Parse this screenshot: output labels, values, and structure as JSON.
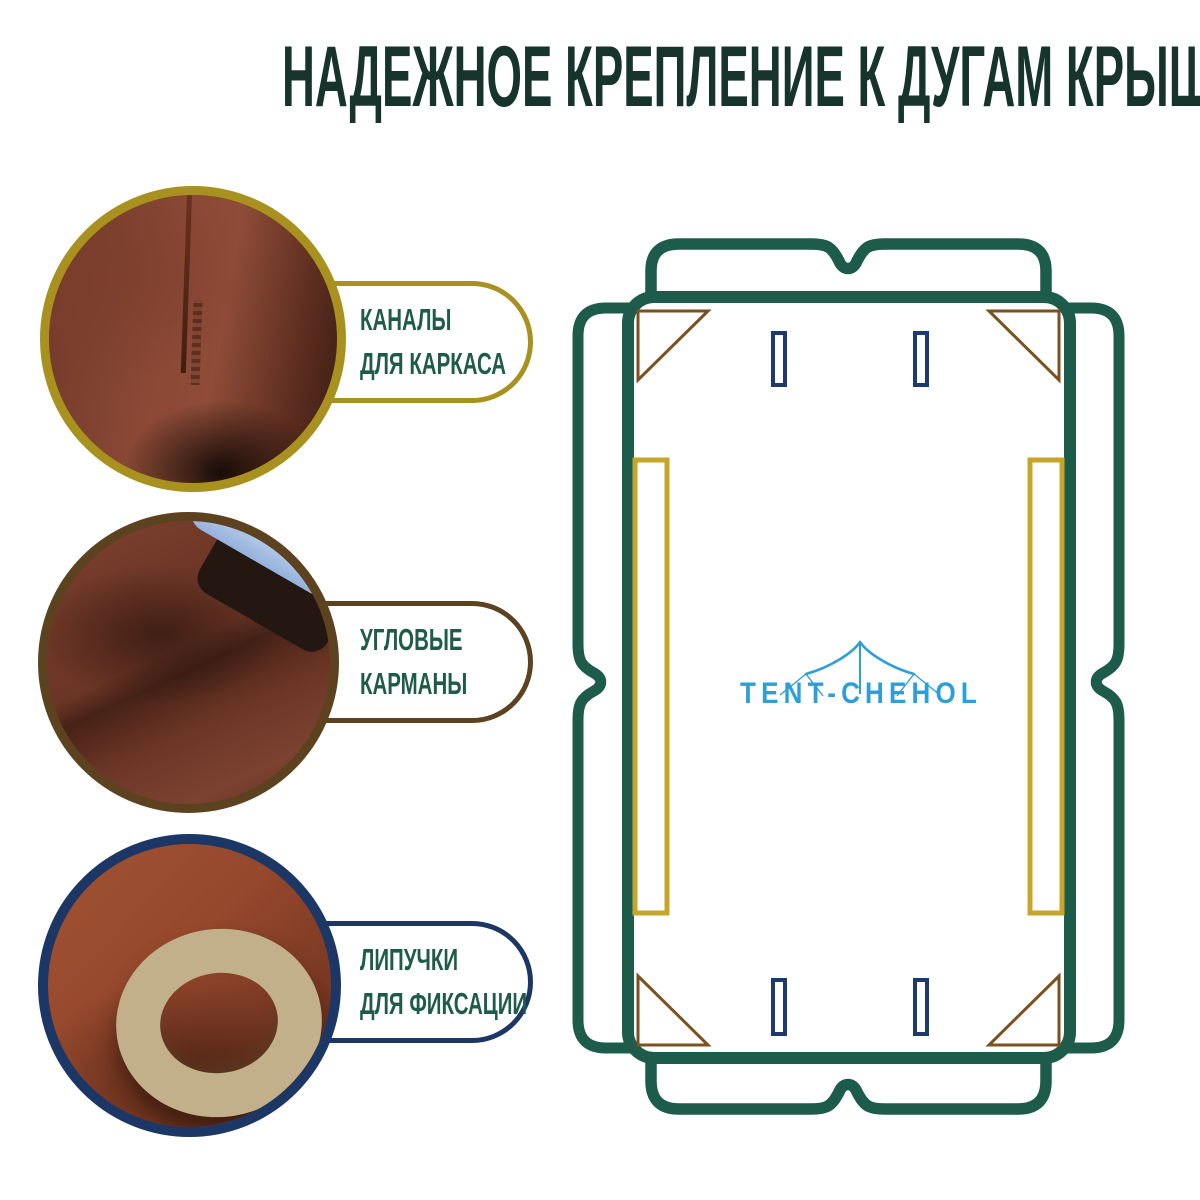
{
  "title": "НАДЕЖНОЕ КРЕПЛЕНИЕ К ДУГАМ КРЫШИ",
  "title_color": "#16332c",
  "label_text_color": "#1e5b48",
  "features": [
    {
      "label_line1": "КАНАЛЫ",
      "label_line2": "ДЛЯ КАРКАСА",
      "accent_color": "#a8911e",
      "photo": "fabric-channel-seam"
    },
    {
      "label_line1": "УГЛОВЫЕ",
      "label_line2": "КАРМАНЫ",
      "accent_color": "#5d4220",
      "photo": "corner-pocket-with-piping"
    },
    {
      "label_line1": "ЛИПУЧКИ",
      "label_line2": "ДЛЯ ФИКСАЦИИ",
      "accent_color": "#1c3766",
      "photo": "velcro-strap-loop"
    }
  ],
  "diagram": {
    "logo_text": "TENT-CHEHOL",
    "colors": {
      "outline_green": "#1d5b4a",
      "frame_channel_gold": "#c6a52a",
      "corner_pocket_brown": "#7a5220",
      "velcro_slot_navy": "#1d3a6e",
      "logo_blue": "#2f9ed8"
    }
  }
}
